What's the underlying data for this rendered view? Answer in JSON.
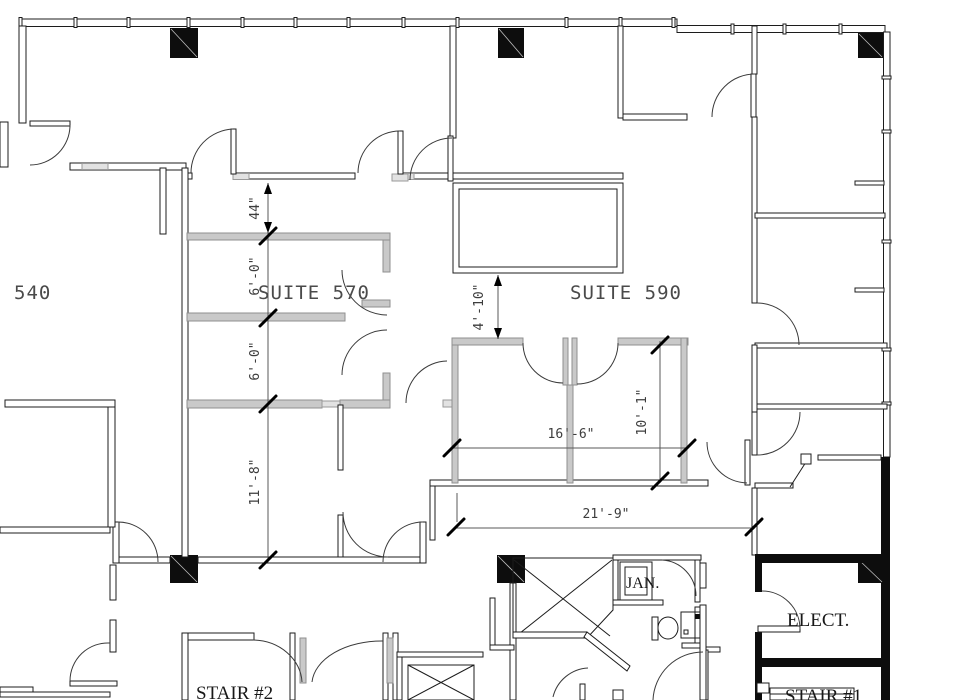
{
  "plan": {
    "title": "office floor plan",
    "unit_labels": {
      "suite_540": "540",
      "suite_570": "SUITE 570",
      "suite_590": "SUITE 590"
    },
    "rooms": {
      "jan": "JAN.",
      "elect": "ELECT.",
      "stair2": "STAIR #2",
      "stair1": "STAIR #1"
    },
    "dimensions": {
      "corridor_width": "44\"",
      "office_a_width": "6'-0\"",
      "office_b_width": "6'-0\"",
      "room_width": "11'-8\"",
      "setback": "4'-10\"",
      "office_depth": "10'-1\"",
      "suite_interior_width": "16'-6\"",
      "overall_width": "21'-9\""
    },
    "colors": {
      "background": "#ffffff",
      "wall_line": "#1c1c1c",
      "solid_wall": "#0d0d0d",
      "partition_gray": "#c9c9c9",
      "dim_text": "#3d3d3d",
      "label_text": "#181818"
    }
  }
}
